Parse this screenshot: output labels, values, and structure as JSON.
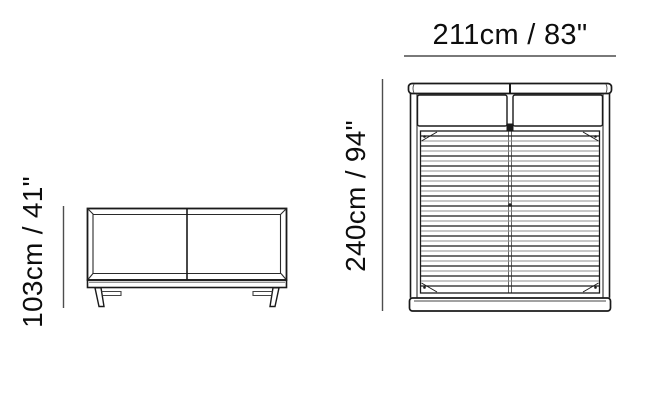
{
  "diagram": {
    "side_view": {
      "height_label": "103cm / 41\""
    },
    "top_view": {
      "width_label": "211cm / 83\"",
      "depth_label": "240cm / 94\""
    }
  },
  "colors": {
    "line": "#1a1a1a",
    "light_line": "#8f8f8f",
    "dimension_line": "#4d4d4d",
    "background": "#ffffff"
  }
}
